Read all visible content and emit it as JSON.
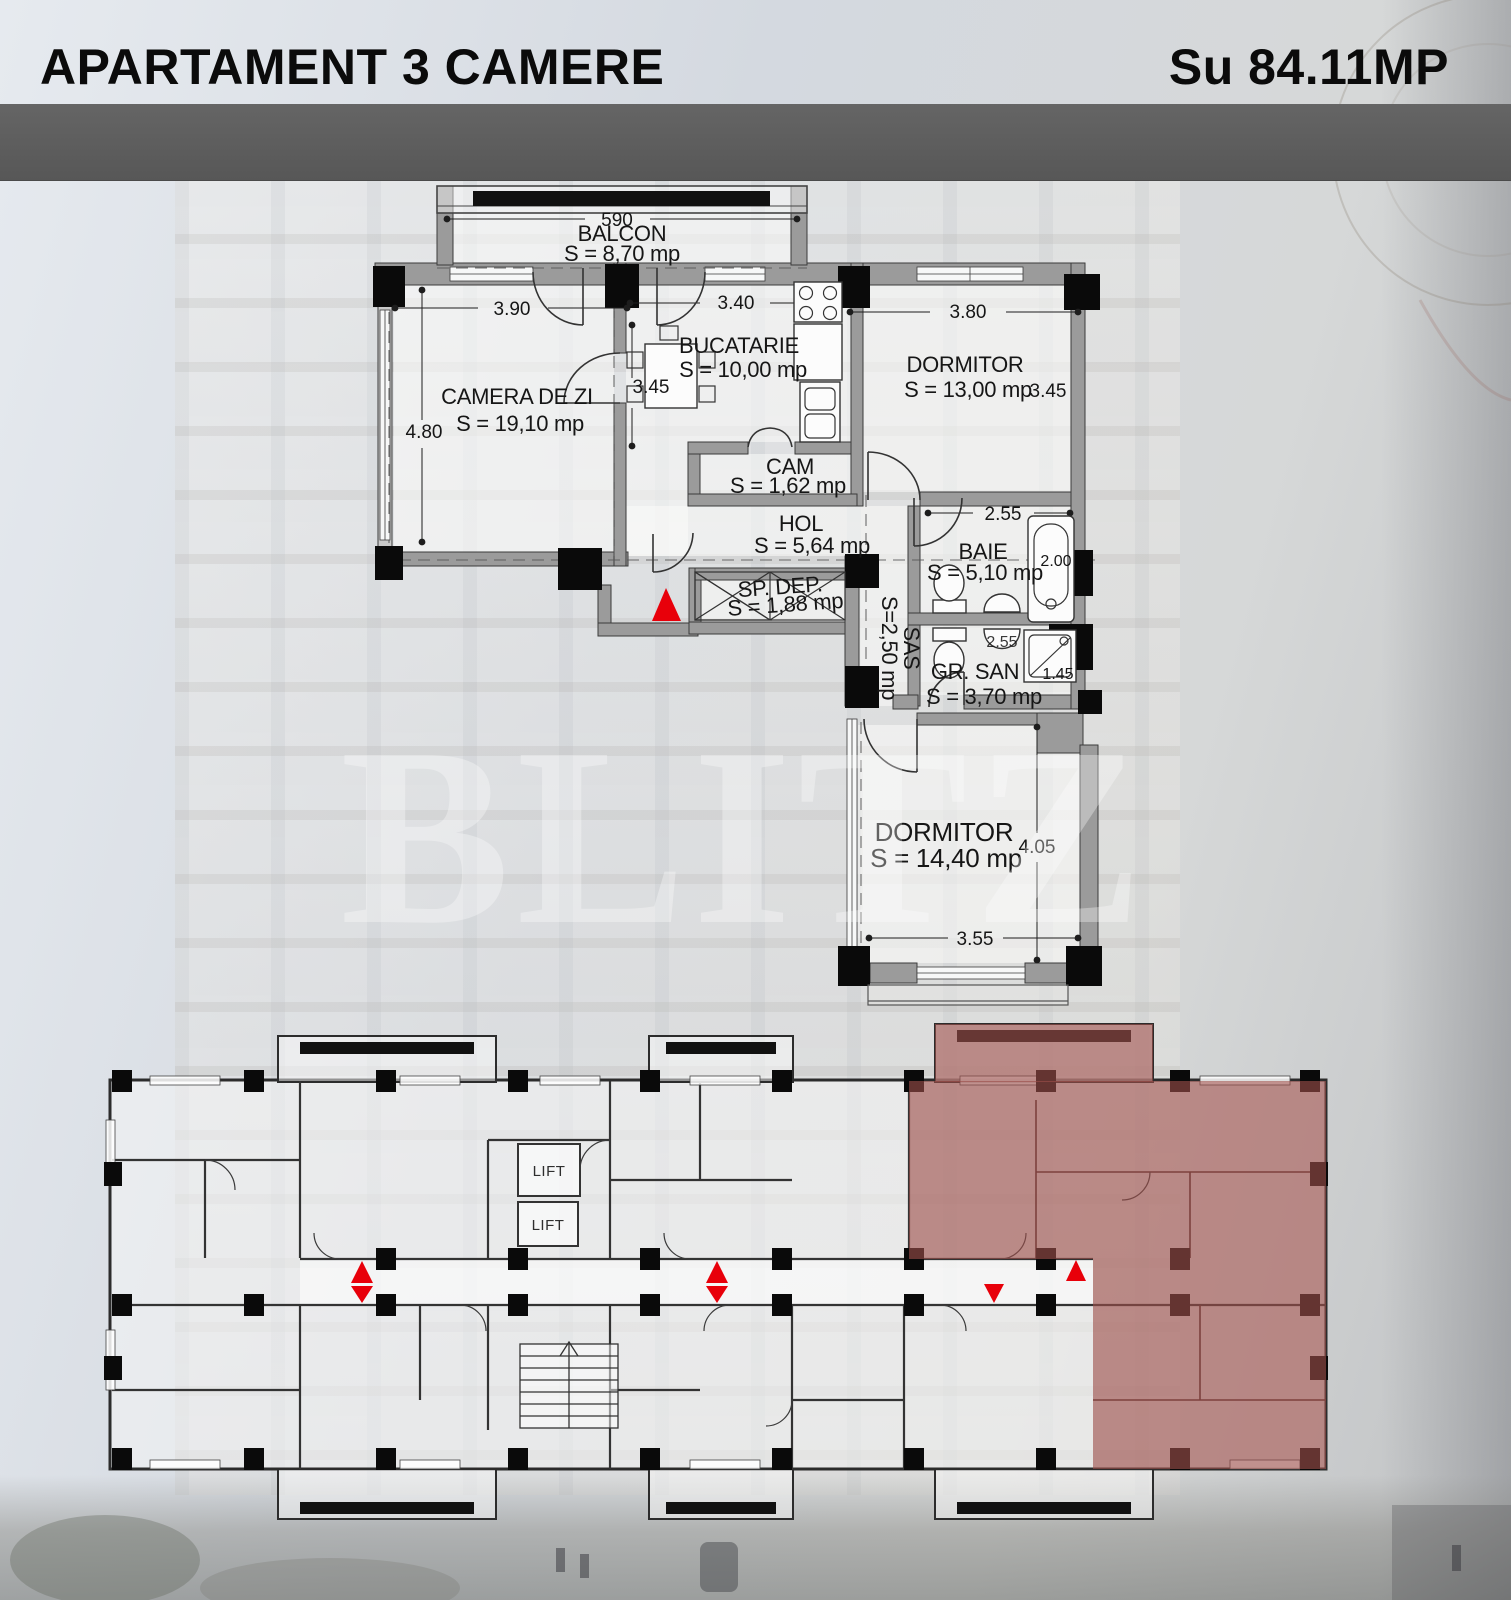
{
  "header": {
    "title": "APARTAMENT 3 CAMERE",
    "surface": "Su 84.11MP"
  },
  "watermark": "BLITZ",
  "apartment_plan": {
    "rooms": [
      {
        "name": "BALCON",
        "area": "S = 8,70 mp"
      },
      {
        "name": "CAMERA DE ZI",
        "area": "S = 19,10 mp"
      },
      {
        "name": "BUCATARIE",
        "area": "S = 10,00 mp"
      },
      {
        "name": "DORMITOR",
        "area": "S = 13,00 mp"
      },
      {
        "name": "CAM",
        "area": "S = 1,62 mp"
      },
      {
        "name": "HOL",
        "area": "S = 5,64 mp"
      },
      {
        "name": "SP. DEP.",
        "area": "S = 1,88 mp"
      },
      {
        "name": "SAS",
        "area": "S=2,50 mp"
      },
      {
        "name": "BAIE",
        "area": "S = 5,10 mp"
      },
      {
        "name": "GR. SAN",
        "area": "S = 3,70 mp"
      },
      {
        "name": "DORMITOR",
        "area": "S = 14,40 mp"
      }
    ],
    "dimensions": {
      "balcon_width": "590",
      "camera_width": "3.90",
      "camera_depth": "4.80",
      "bucatarie_width": "3.40",
      "bucatarie_depth": "3.45",
      "dormitor1_width": "3.80",
      "dormitor1_depth": "3.45",
      "baie_width": "2.55",
      "baie_depth": "2.00",
      "grsan_width": "2.55",
      "grsan_side": "1.45",
      "dormitor2_depth": "4.05",
      "dormitor2_width": "3.55"
    },
    "entrance_marker_color": "#e8000a"
  },
  "floor_overview": {
    "lifts": [
      "LIFT",
      "LIFT"
    ],
    "highlight_color": "#9d4f4a",
    "arrow_color": "#e8000a"
  }
}
